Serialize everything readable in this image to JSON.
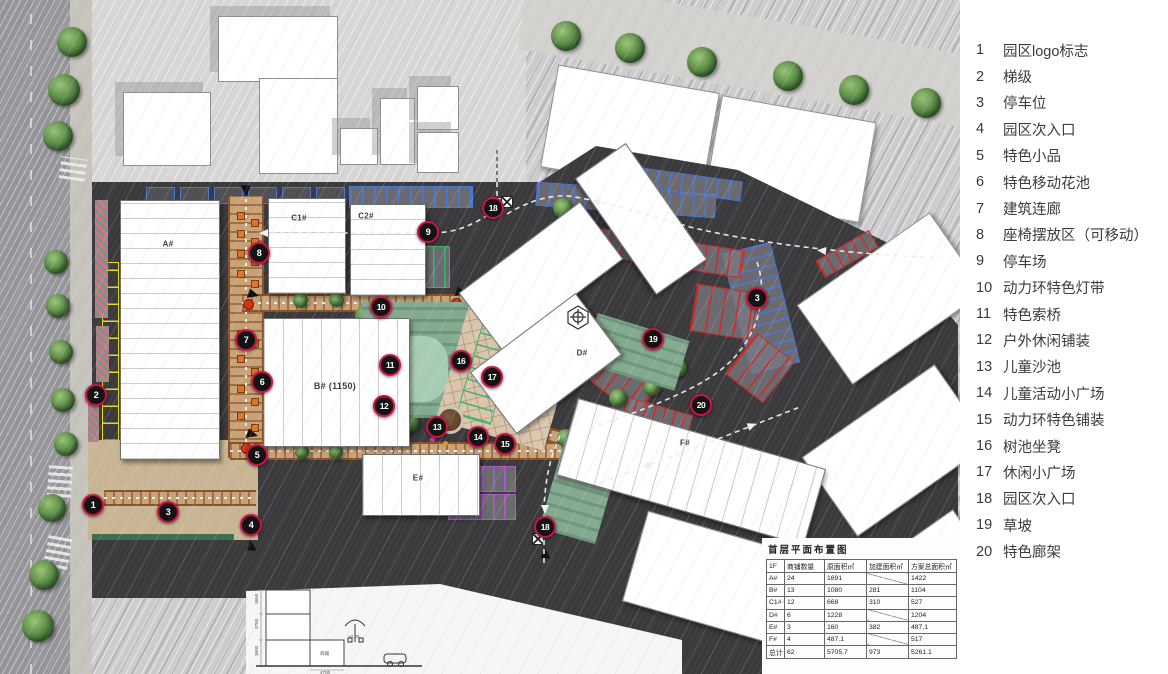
{
  "legend": {
    "items": [
      {
        "num": "1",
        "label": "园区logo标志"
      },
      {
        "num": "2",
        "label": "梯级"
      },
      {
        "num": "3",
        "label": "停车位"
      },
      {
        "num": "4",
        "label": "园区次入口"
      },
      {
        "num": "5",
        "label": "特色小品"
      },
      {
        "num": "6",
        "label": "特色移动花池"
      },
      {
        "num": "7",
        "label": "建筑连廊"
      },
      {
        "num": "8",
        "label": "座椅摆放区（可移动）"
      },
      {
        "num": "9",
        "label": "停车场"
      },
      {
        "num": "10",
        "label": "动力环特色灯带"
      },
      {
        "num": "11",
        "label": "特色索桥"
      },
      {
        "num": "12",
        "label": "户外休闲铺装"
      },
      {
        "num": "13",
        "label": "儿童沙池"
      },
      {
        "num": "14",
        "label": "儿童活动小广场"
      },
      {
        "num": "15",
        "label": "动力环特色铺装"
      },
      {
        "num": "16",
        "label": "树池坐凳"
      },
      {
        "num": "17",
        "label": "休闲小广场"
      },
      {
        "num": "18",
        "label": "园区次入口"
      },
      {
        "num": "19",
        "label": "草坡"
      },
      {
        "num": "20",
        "label": "特色廊架"
      }
    ]
  },
  "plan": {
    "buildings": {
      "a": "A#",
      "b": "B# (1150)",
      "c1": "C1#",
      "c2": "C2#",
      "d": "D#",
      "e": "E#",
      "f": "F#"
    },
    "markers": [
      {
        "n": "1",
        "x": 93,
        "y": 505
      },
      {
        "n": "2",
        "x": 96,
        "y": 395
      },
      {
        "n": "3",
        "x": 168,
        "y": 512
      },
      {
        "n": "3",
        "x": 757,
        "y": 298
      },
      {
        "n": "4",
        "x": 251,
        "y": 525
      },
      {
        "n": "5",
        "x": 257,
        "y": 455
      },
      {
        "n": "6",
        "x": 262,
        "y": 382
      },
      {
        "n": "7",
        "x": 246,
        "y": 340
      },
      {
        "n": "8",
        "x": 259,
        "y": 253
      },
      {
        "n": "9",
        "x": 428,
        "y": 232
      },
      {
        "n": "10",
        "x": 381,
        "y": 307
      },
      {
        "n": "11",
        "x": 390,
        "y": 365
      },
      {
        "n": "12",
        "x": 384,
        "y": 406
      },
      {
        "n": "13",
        "x": 437,
        "y": 427
      },
      {
        "n": "14",
        "x": 478,
        "y": 437
      },
      {
        "n": "15",
        "x": 505,
        "y": 444
      },
      {
        "n": "16",
        "x": 461,
        "y": 361
      },
      {
        "n": "17",
        "x": 492,
        "y": 377
      },
      {
        "n": "18",
        "x": 493,
        "y": 208
      },
      {
        "n": "18",
        "x": 545,
        "y": 527
      },
      {
        "n": "19",
        "x": 653,
        "y": 339
      },
      {
        "n": "20",
        "x": 701,
        "y": 405
      }
    ]
  },
  "table": {
    "title": "首层平面布置图",
    "headers": [
      "1F",
      "商铺数量",
      "原面积㎡",
      "加建面积㎡",
      "方案总面积㎡"
    ],
    "rows": [
      [
        "A#",
        "24",
        "1691",
        "",
        "1422"
      ],
      [
        "B#",
        "13",
        "1080",
        "281",
        "1104"
      ],
      [
        "C1# C2#",
        "12",
        "668",
        "310",
        "527"
      ],
      [
        "D#",
        "6",
        "1228",
        "",
        "1204"
      ],
      [
        "E#",
        "3",
        "160",
        "382",
        "487.1"
      ],
      [
        "F#",
        "4",
        "487.1",
        "",
        "517"
      ],
      [
        "总计",
        "62",
        "5705.7",
        "973",
        "5261.1"
      ]
    ]
  },
  "section": {
    "dims": [
      "3650",
      "3750",
      "3600"
    ],
    "span": "4700",
    "room": "商铺",
    "level": "±0.00"
  },
  "colors": {
    "site": "#3a3a3d",
    "marker_ring": "#d01345",
    "parking_blue": "#4a79d8",
    "parking_red": "#cf2a2a",
    "parking_green": "#3db06a",
    "parking_purple": "#b05ad0",
    "parking_yellow": "#e8d81f",
    "walkway": "#c9a377",
    "lawn": "#84ab90",
    "route": "#f0f0f0"
  }
}
